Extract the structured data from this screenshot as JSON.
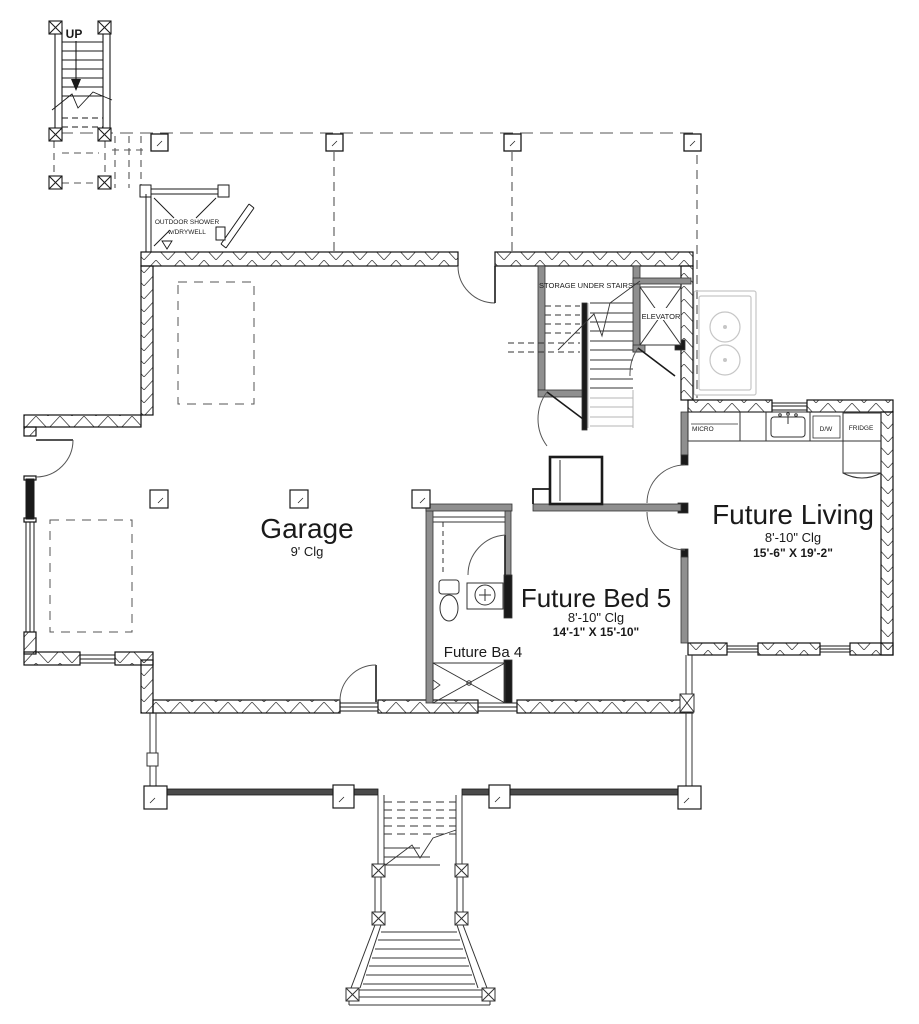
{
  "meta": {
    "drawing_type": "floor-plan",
    "colors": {
      "ink": "#1a1a1a",
      "wall_gray": "#8f8f8f",
      "rail_dark": "#4a4a4a",
      "ghost_gray": "#c6c6c6",
      "stair_light": "#b5b5b5",
      "background": "#ffffff"
    }
  },
  "rooms": [
    {
      "id": "garage",
      "name": "Garage",
      "ceiling": "9' Clg",
      "dimensions": ""
    },
    {
      "id": "future_bed_5",
      "name": "Future Bed 5",
      "ceiling": "8'-10\" Clg",
      "dimensions": "14'-1\" X 15'-10\""
    },
    {
      "id": "future_living",
      "name": "Future Living",
      "ceiling": "8'-10\" Clg",
      "dimensions": "15'-6\" X 19'-2\""
    },
    {
      "id": "future_bath_4",
      "name": "Future Ba 4"
    },
    {
      "id": "storage_under_stairs",
      "name": "STORAGE UNDER STAIRS"
    },
    {
      "id": "elevator",
      "name": "ELEVATOR"
    }
  ],
  "annotations": {
    "stair_up": "UP",
    "outdoor_shower_line1": "OUTDOOR SHOWER",
    "outdoor_shower_line2": "w/DRYWELL"
  },
  "kitchen": {
    "appliances": [
      {
        "id": "microwave",
        "label": "MICRO"
      },
      {
        "id": "dishwasher",
        "label": "D/W"
      },
      {
        "id": "refrigerator",
        "label": "FRIDGE"
      }
    ]
  }
}
